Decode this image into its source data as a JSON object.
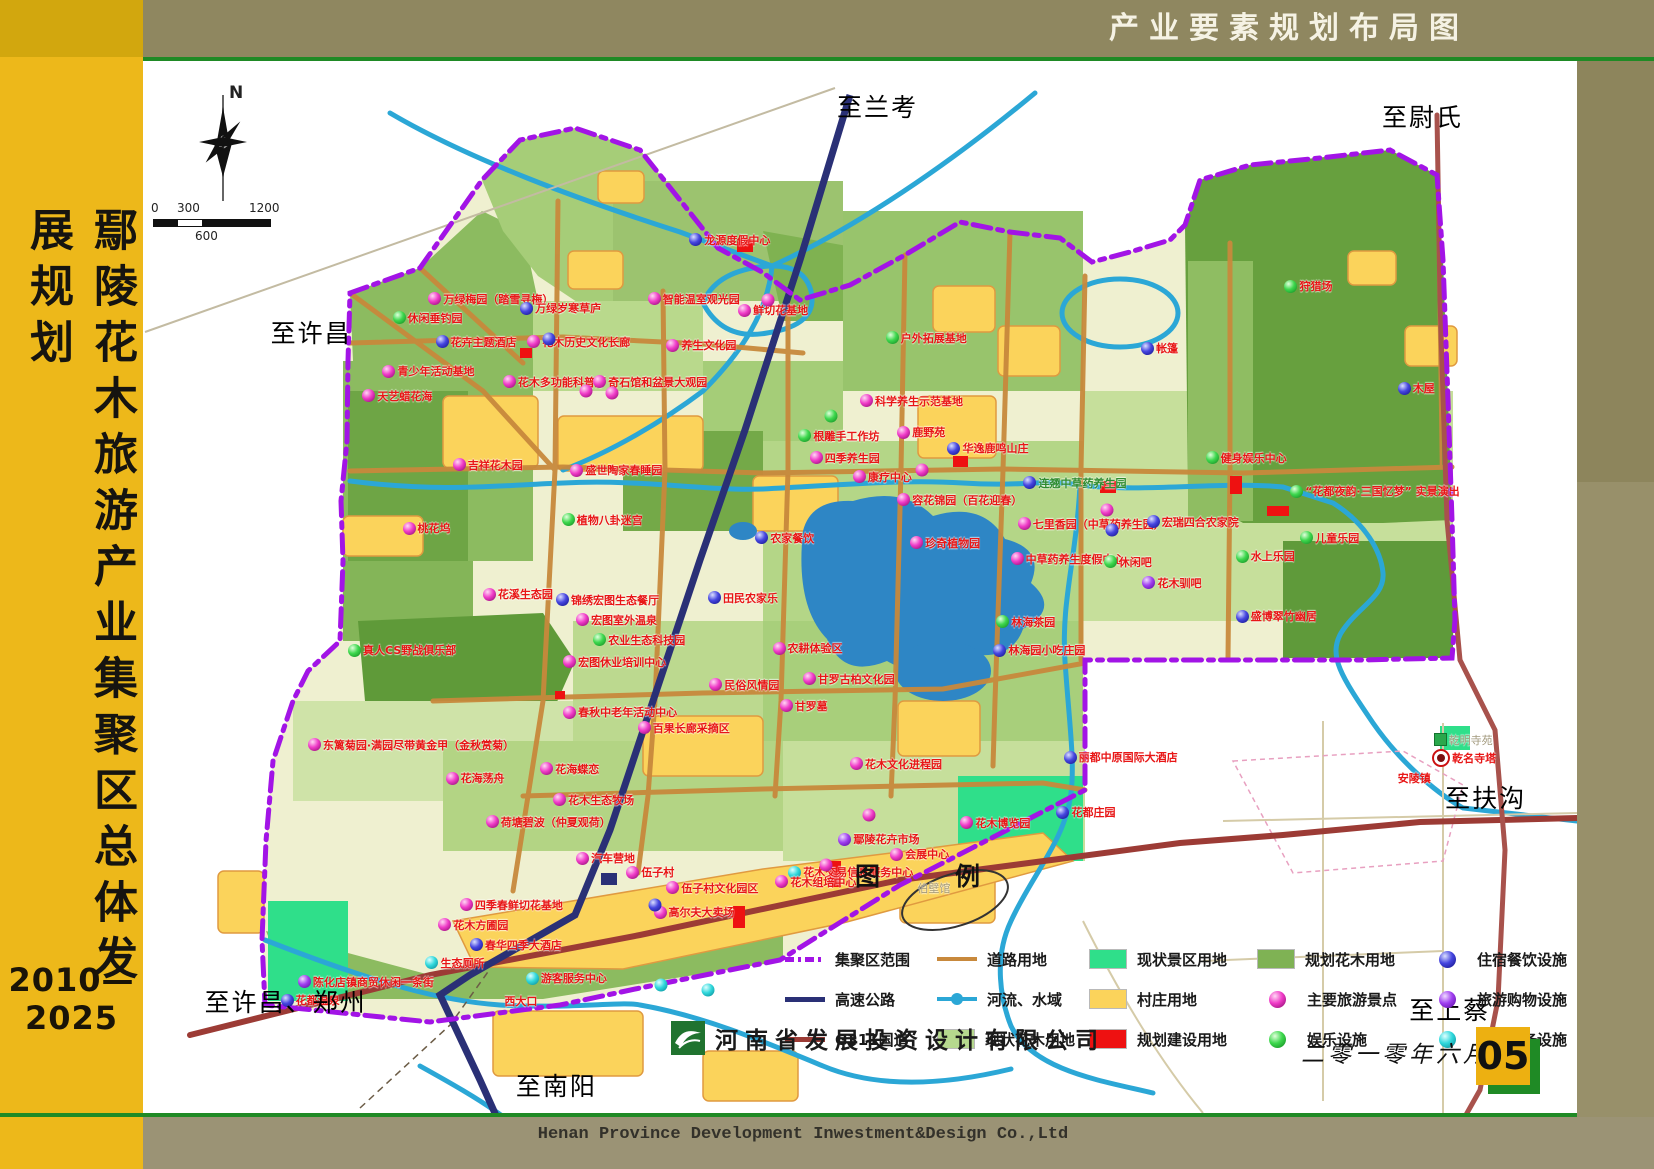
{
  "header": {
    "title": "产业要素规划布局图"
  },
  "sidebar": {
    "title": "鄢陵花木旅游产业集聚区总体发展规划",
    "period": "2010—2025"
  },
  "footer": {
    "company_cn": "河南省发展投资设计有限公司",
    "company_en": "Henan Province Development Inwestment&Design Co.,Ltd",
    "date": "二零一零年六月",
    "page": "05"
  },
  "compass": {
    "label": "N"
  },
  "scalebar": {
    "t0": "0",
    "t300": "300",
    "t600": "600",
    "t1200": "1200"
  },
  "colors": {
    "boundary_purple": "#a214e6",
    "expressway_navy": "#2a3076",
    "g311_maroon": "#9c3b35",
    "road_orange": "#c8893c",
    "river_cyan": "#2ba7d6",
    "scenic_green": "#2fdf8a",
    "village_yellow": "#fbd35b",
    "construction_red": "#ee1111",
    "flower_existing": "#b6d98e",
    "flower_planned": "#7fb254",
    "sidebar_yellow": "#edb81a",
    "header_olive": "#8f8760"
  },
  "legend": {
    "title": "图　　　例",
    "columns": [
      [
        {
          "label": "集聚区范围",
          "sym": "boundary"
        },
        {
          "label": "高速公路",
          "sym": "navy"
        },
        {
          "label": "G311国道",
          "sym": "maroon"
        }
      ],
      [
        {
          "label": "道路用地",
          "sym": "orange"
        },
        {
          "label": "河流、水域",
          "sym": "river"
        },
        {
          "label": "现状花木用地",
          "sym": "lightgreen"
        }
      ],
      [
        {
          "label": "现状景区用地",
          "sym": "scenic"
        },
        {
          "label": "村庄用地",
          "sym": "village"
        },
        {
          "label": "规划建设用地",
          "sym": "red"
        }
      ],
      [
        {
          "label": "规划花木用地",
          "sym": "midgreen"
        },
        {
          "label": "主要旅游景点",
          "sym": "sph-magenta"
        },
        {
          "label": "娱乐设施",
          "sym": "sph-green"
        }
      ],
      [
        {
          "label": "住宿餐饮设施",
          "sym": "sph-blue"
        },
        {
          "label": "旅游购物设施",
          "sym": "sph-violet"
        },
        {
          "label": "公共服务设施",
          "sym": "sph-cyan"
        }
      ]
    ]
  },
  "map": {
    "labels": [
      {
        "t": "龙源度假中心",
        "x": 38.1,
        "y": 17.0,
        "d": "blue"
      },
      {
        "t": "万绿梅园（踏雪寻梅）",
        "x": 19.9,
        "y": 22.6,
        "d": "magenta"
      },
      {
        "t": "休闲垂钓园",
        "x": 17.4,
        "y": 24.4,
        "d": "green"
      },
      {
        "t": "万绿岁寒草庐",
        "x": 26.3,
        "y": 23.5,
        "d": "blue"
      },
      {
        "t": "花卉主题酒店",
        "x": 20.4,
        "y": 26.7,
        "d": "blue"
      },
      {
        "t": "花木历史文化长廊",
        "x": 26.8,
        "y": 26.7,
        "d": "magenta"
      },
      {
        "t": "智能温室观光园",
        "x": 35.2,
        "y": 22.6,
        "d": "magenta"
      },
      {
        "t": "鲜切花基地",
        "x": 41.5,
        "y": 23.7,
        "d": "magenta"
      },
      {
        "t": "户外拓展基地",
        "x": 51.8,
        "y": 26.3,
        "d": "green"
      },
      {
        "t": "养生文化园",
        "x": 36.5,
        "y": 27.0,
        "d": "magenta"
      },
      {
        "t": "青少年活动基地",
        "x": 16.7,
        "y": 29.5,
        "d": "magenta"
      },
      {
        "t": "天艺蜡花海",
        "x": 15.3,
        "y": 31.8,
        "d": "magenta"
      },
      {
        "t": "花木多功能科普厅",
        "x": 25.1,
        "y": 30.5,
        "d": "magenta"
      },
      {
        "t": "奇石馆和盆景大观园",
        "x": 31.4,
        "y": 30.5,
        "d": "magenta"
      },
      {
        "t": "科学养生示范基地",
        "x": 50.0,
        "y": 32.3,
        "d": "magenta"
      },
      {
        "t": "根雕手工作坊",
        "x": 45.7,
        "y": 35.6,
        "d": "green"
      },
      {
        "t": "鹿野苑",
        "x": 52.6,
        "y": 35.3,
        "d": "magenta"
      },
      {
        "t": "四季养生园",
        "x": 46.5,
        "y": 37.7,
        "d": "magenta"
      },
      {
        "t": "华逸鹿鸣山庄",
        "x": 56.1,
        "y": 36.8,
        "d": "blue"
      },
      {
        "t": "康疗中心",
        "x": 49.5,
        "y": 39.5,
        "d": "magenta"
      },
      {
        "t": "容花锦园（百花迎春）",
        "x": 52.6,
        "y": 41.7,
        "d": "magenta"
      },
      {
        "t": "连翘中草药养生园",
        "x": 61.4,
        "y": 40.1,
        "d": "blue",
        "c": "green"
      },
      {
        "t": "七里香园（中草药养生园）",
        "x": 61.0,
        "y": 44.0,
        "d": "magenta"
      },
      {
        "t": "宏瑞四合农家院",
        "x": 70.0,
        "y": 43.8,
        "d": "blue"
      },
      {
        "t": "健身娱乐中心",
        "x": 74.1,
        "y": 37.7,
        "d": "green"
      },
      {
        "t": "“花都夜韵·三国忆梦” 实景演出",
        "x": 80.0,
        "y": 40.9,
        "d": "green"
      },
      {
        "t": "水上乐园",
        "x": 76.2,
        "y": 47.1,
        "d": "green"
      },
      {
        "t": "儿童乐园",
        "x": 80.7,
        "y": 45.3,
        "d": "green"
      },
      {
        "t": "珍奇植物园",
        "x": 53.5,
        "y": 45.8,
        "d": "magenta"
      },
      {
        "t": "中草药养生度假中心",
        "x": 60.5,
        "y": 47.3,
        "d": "magenta"
      },
      {
        "t": "休闲吧",
        "x": 67.0,
        "y": 47.6,
        "d": "green"
      },
      {
        "t": "花木驯吧",
        "x": 69.7,
        "y": 49.6,
        "d": "violet"
      },
      {
        "t": "农家餐饮",
        "x": 42.7,
        "y": 45.3,
        "d": "blue"
      },
      {
        "t": "吉祥花木园",
        "x": 21.6,
        "y": 38.4,
        "d": "magenta"
      },
      {
        "t": "盛世陶家春睡园",
        "x": 29.8,
        "y": 38.9,
        "d": "magenta"
      },
      {
        "t": "桃花坞",
        "x": 18.1,
        "y": 44.4,
        "d": "magenta"
      },
      {
        "t": "植物八卦迷宫",
        "x": 29.2,
        "y": 43.6,
        "d": "green"
      },
      {
        "t": "花溪生态园",
        "x": 23.7,
        "y": 50.7,
        "d": "magenta"
      },
      {
        "t": "锦绣宏图生态餐厅",
        "x": 28.8,
        "y": 51.2,
        "d": "blue"
      },
      {
        "t": "宏图室外温泉",
        "x": 30.2,
        "y": 53.1,
        "d": "magenta"
      },
      {
        "t": "田民农家乐",
        "x": 39.4,
        "y": 51.0,
        "d": "blue"
      },
      {
        "t": "农业生态科技园",
        "x": 31.4,
        "y": 55.0,
        "d": "green"
      },
      {
        "t": "宏图休业培训中心",
        "x": 29.3,
        "y": 57.1,
        "d": "magenta"
      },
      {
        "t": "真人CS野战俱乐部",
        "x": 14.3,
        "y": 56.0,
        "d": "green"
      },
      {
        "t": "农耕体验区",
        "x": 43.9,
        "y": 55.8,
        "d": "magenta"
      },
      {
        "t": "民俗风情园",
        "x": 39.5,
        "y": 59.3,
        "d": "magenta"
      },
      {
        "t": "甘罗古柏文化园",
        "x": 46.0,
        "y": 58.7,
        "d": "magenta"
      },
      {
        "t": "甘罗墓",
        "x": 44.4,
        "y": 61.3,
        "d": "magenta"
      },
      {
        "t": "林海茶园",
        "x": 59.5,
        "y": 53.3,
        "d": "green"
      },
      {
        "t": "林海园小吃庄园",
        "x": 59.3,
        "y": 56.0,
        "d": "blue"
      },
      {
        "t": "盛博翠竹幽居",
        "x": 76.2,
        "y": 52.8,
        "d": "blue"
      },
      {
        "t": "春秋中老年活动中心",
        "x": 29.3,
        "y": 61.9,
        "d": "magenta"
      },
      {
        "t": "百果长廊采摘区",
        "x": 34.5,
        "y": 63.4,
        "d": "magenta"
      },
      {
        "t": "东篱菊园·满园尽带黄金甲（金秋赏菊）",
        "x": 11.5,
        "y": 65.0,
        "d": "magenta"
      },
      {
        "t": "花海荡舟",
        "x": 21.1,
        "y": 68.2,
        "d": "magenta"
      },
      {
        "t": "花海蝶恋",
        "x": 27.7,
        "y": 67.3,
        "d": "magenta"
      },
      {
        "t": "花木生态牧场",
        "x": 28.6,
        "y": 70.2,
        "d": "magenta"
      },
      {
        "t": "荷塘碧波（仲夏观荷）",
        "x": 23.9,
        "y": 72.3,
        "d": "magenta"
      },
      {
        "t": "花木文化进程园",
        "x": 49.3,
        "y": 66.8,
        "d": "magenta"
      },
      {
        "t": "花木博览园",
        "x": 57.0,
        "y": 72.4,
        "d": "magenta"
      },
      {
        "t": "鄢陵花卉市场",
        "x": 48.5,
        "y": 74.0,
        "d": "violet"
      },
      {
        "t": "会展中心",
        "x": 52.1,
        "y": 75.4,
        "d": "magenta"
      },
      {
        "t": "花木交易信息服务中心",
        "x": 45.0,
        "y": 77.1,
        "d": "cyan"
      },
      {
        "t": "丽都中原国际大酒店",
        "x": 64.2,
        "y": 66.2,
        "d": "blue"
      },
      {
        "t": "花都庄园",
        "x": 63.7,
        "y": 71.4,
        "d": "blue"
      },
      {
        "t": "汽车营地",
        "x": 30.2,
        "y": 75.8,
        "d": "magenta"
      },
      {
        "t": "伍子村",
        "x": 33.7,
        "y": 77.1,
        "d": "magenta"
      },
      {
        "t": "伍子村文化园区",
        "x": 36.5,
        "y": 78.6,
        "d": "magenta"
      },
      {
        "t": "高尔夫大卖场",
        "x": 35.6,
        "y": 80.9,
        "d": "magenta"
      },
      {
        "t": "花木组培中心",
        "x": 44.1,
        "y": 78.0,
        "d": "magenta"
      },
      {
        "t": "四季春鲜切花基地",
        "x": 22.1,
        "y": 80.2,
        "d": "magenta"
      },
      {
        "t": "花木方圃园",
        "x": 20.6,
        "y": 82.1,
        "d": "magenta"
      },
      {
        "t": "春华四季大酒店",
        "x": 22.8,
        "y": 84.0,
        "d": "blue"
      },
      {
        "t": "生态厕所",
        "x": 19.7,
        "y": 85.7,
        "d": "cyan"
      },
      {
        "t": "游客服务中心",
        "x": 26.7,
        "y": 87.2,
        "d": "cyan"
      },
      {
        "t": "陈化店镇商贸休闲一条街",
        "x": 10.8,
        "y": 87.5,
        "d": "violet"
      },
      {
        "t": "花都温泉",
        "x": 9.6,
        "y": 89.3,
        "d": "blue"
      },
      {
        "t": "西大口",
        "x": 25.2,
        "y": 89.4
      },
      {
        "t": "狩猎场",
        "x": 79.6,
        "y": 21.4,
        "d": "green"
      },
      {
        "t": "帐篷",
        "x": 69.6,
        "y": 27.3,
        "d": "blue"
      },
      {
        "t": "木屋",
        "x": 87.5,
        "y": 31.1,
        "d": "blue"
      },
      {
        "t": "乾名寺塔",
        "x": 89.9,
        "y": 66.3,
        "d": "target"
      },
      {
        "t": "安陵镇",
        "x": 87.5,
        "y": 68.2
      },
      {
        "t": "乾明寺苑",
        "x": 90.0,
        "y": 64.5,
        "d": "greensq",
        "c": "gray"
      },
      {
        "t": "伯壁馆",
        "x": 54.0,
        "y": 78.6,
        "c": "gray"
      }
    ],
    "edge_labels": [
      {
        "t": "至兰考",
        "x": 48.4,
        "y": 4.3
      },
      {
        "t": "至尉氏",
        "x": 86.4,
        "y": 5.2
      },
      {
        "t": "至许昌",
        "x": 8.9,
        "y": 25.8
      },
      {
        "t": "至扶沟",
        "x": 90.8,
        "y": 70.0
      },
      {
        "t": "至上蔡",
        "x": 88.3,
        "y": 90.1
      },
      {
        "t": "至许昌、郑州",
        "x": 4.3,
        "y": 89.4
      },
      {
        "t": "至南阳",
        "x": 26.0,
        "y": 97.3
      }
    ],
    "extra_markers": [
      {
        "c": "magenta",
        "x": 43.6,
        "y": 22.7
      },
      {
        "c": "blue",
        "x": 28.3,
        "y": 26.4
      },
      {
        "c": "magenta",
        "x": 30.9,
        "y": 31.4
      },
      {
        "c": "magenta",
        "x": 32.7,
        "y": 31.6
      },
      {
        "c": "magenta",
        "x": 54.3,
        "y": 38.9
      },
      {
        "c": "blue",
        "x": 67.6,
        "y": 44.6
      },
      {
        "c": "magenta",
        "x": 67.2,
        "y": 42.7
      },
      {
        "c": "green",
        "x": 48.0,
        "y": 33.7
      },
      {
        "c": "cyan",
        "x": 39.4,
        "y": 88.3
      },
      {
        "c": "cyan",
        "x": 36.1,
        "y": 87.8
      },
      {
        "c": "blue",
        "x": 35.7,
        "y": 80.2
      },
      {
        "c": "magenta",
        "x": 47.6,
        "y": 76.4
      },
      {
        "c": "magenta",
        "x": 50.6,
        "y": 71.7
      }
    ]
  }
}
